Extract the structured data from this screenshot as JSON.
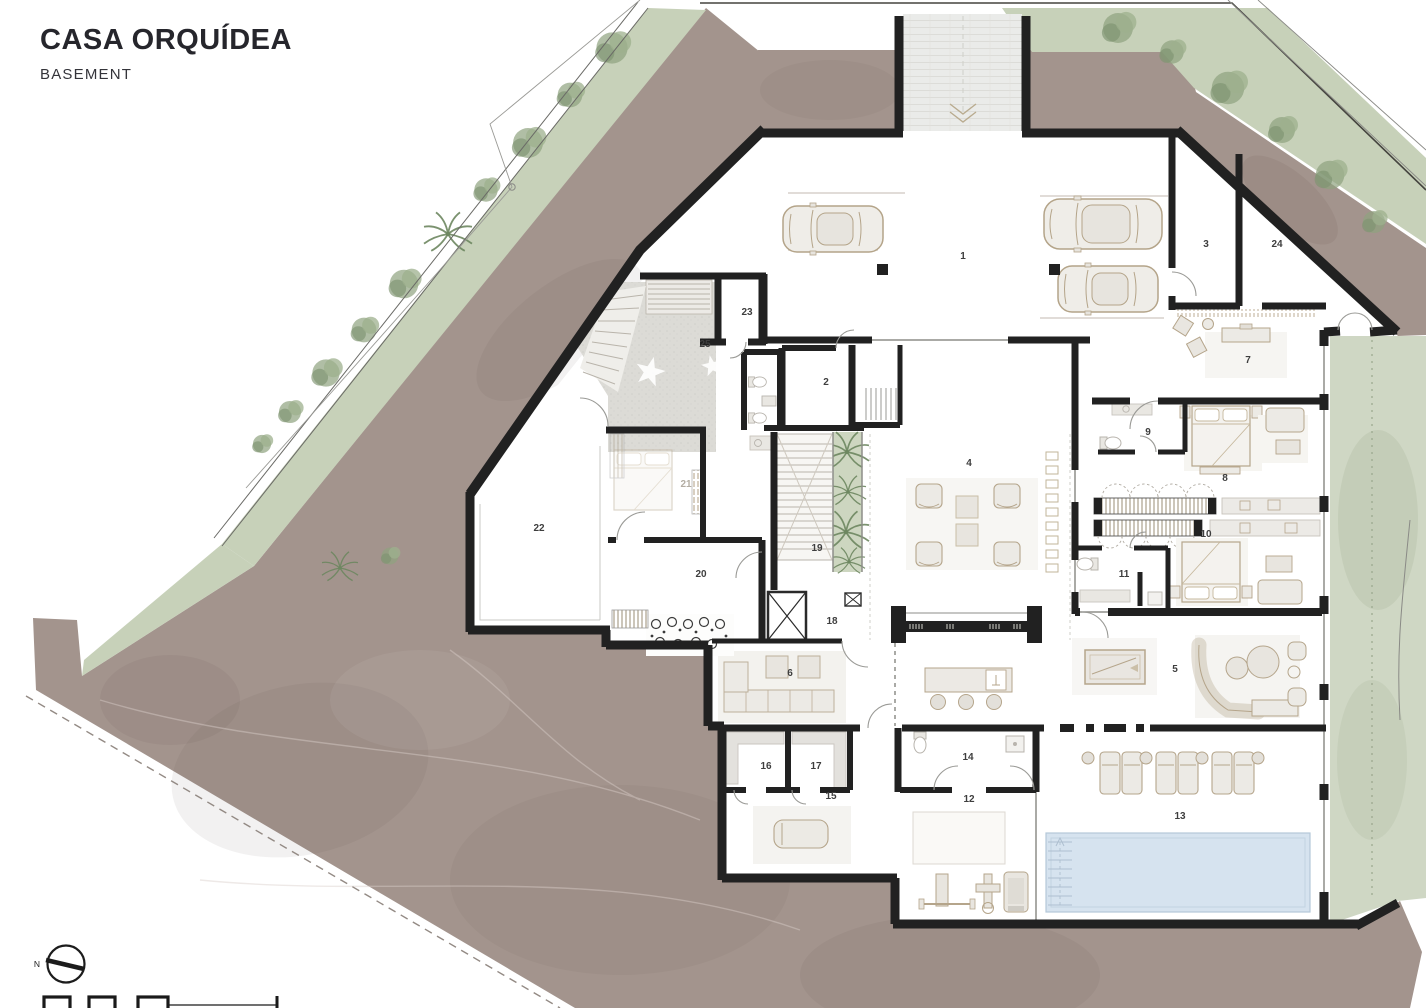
{
  "header": {
    "title": "CASA ORQUÍDEA",
    "subtitle": "BASEMENT"
  },
  "compass": {
    "label": "N"
  },
  "rooms": {
    "r1": "1",
    "r2": "2",
    "r3": "3",
    "r4": "4",
    "r5": "5",
    "r6": "6",
    "r7": "7",
    "r8": "8",
    "r9": "9",
    "r10": "10",
    "r11": "11",
    "r12": "12",
    "r13": "13",
    "r14": "14",
    "r15": "15",
    "r16": "16",
    "r17": "17",
    "r18": "18",
    "r19": "19",
    "r20": "20",
    "r21": "21",
    "r22": "22",
    "r23": "23",
    "r24": "24",
    "r25": "25"
  },
  "colors": {
    "terrain": "#a3948d",
    "vegetation_band": "#c7d1b9",
    "vegetation_side": "#cfd7c4",
    "tree_canopy": "#8ea37f",
    "wall": "#212121",
    "pool_water": "#d6e3ef",
    "patio_stone": "#dcdbd6",
    "furniture_line": "#b5a58b",
    "paper": "#ffffff"
  }
}
